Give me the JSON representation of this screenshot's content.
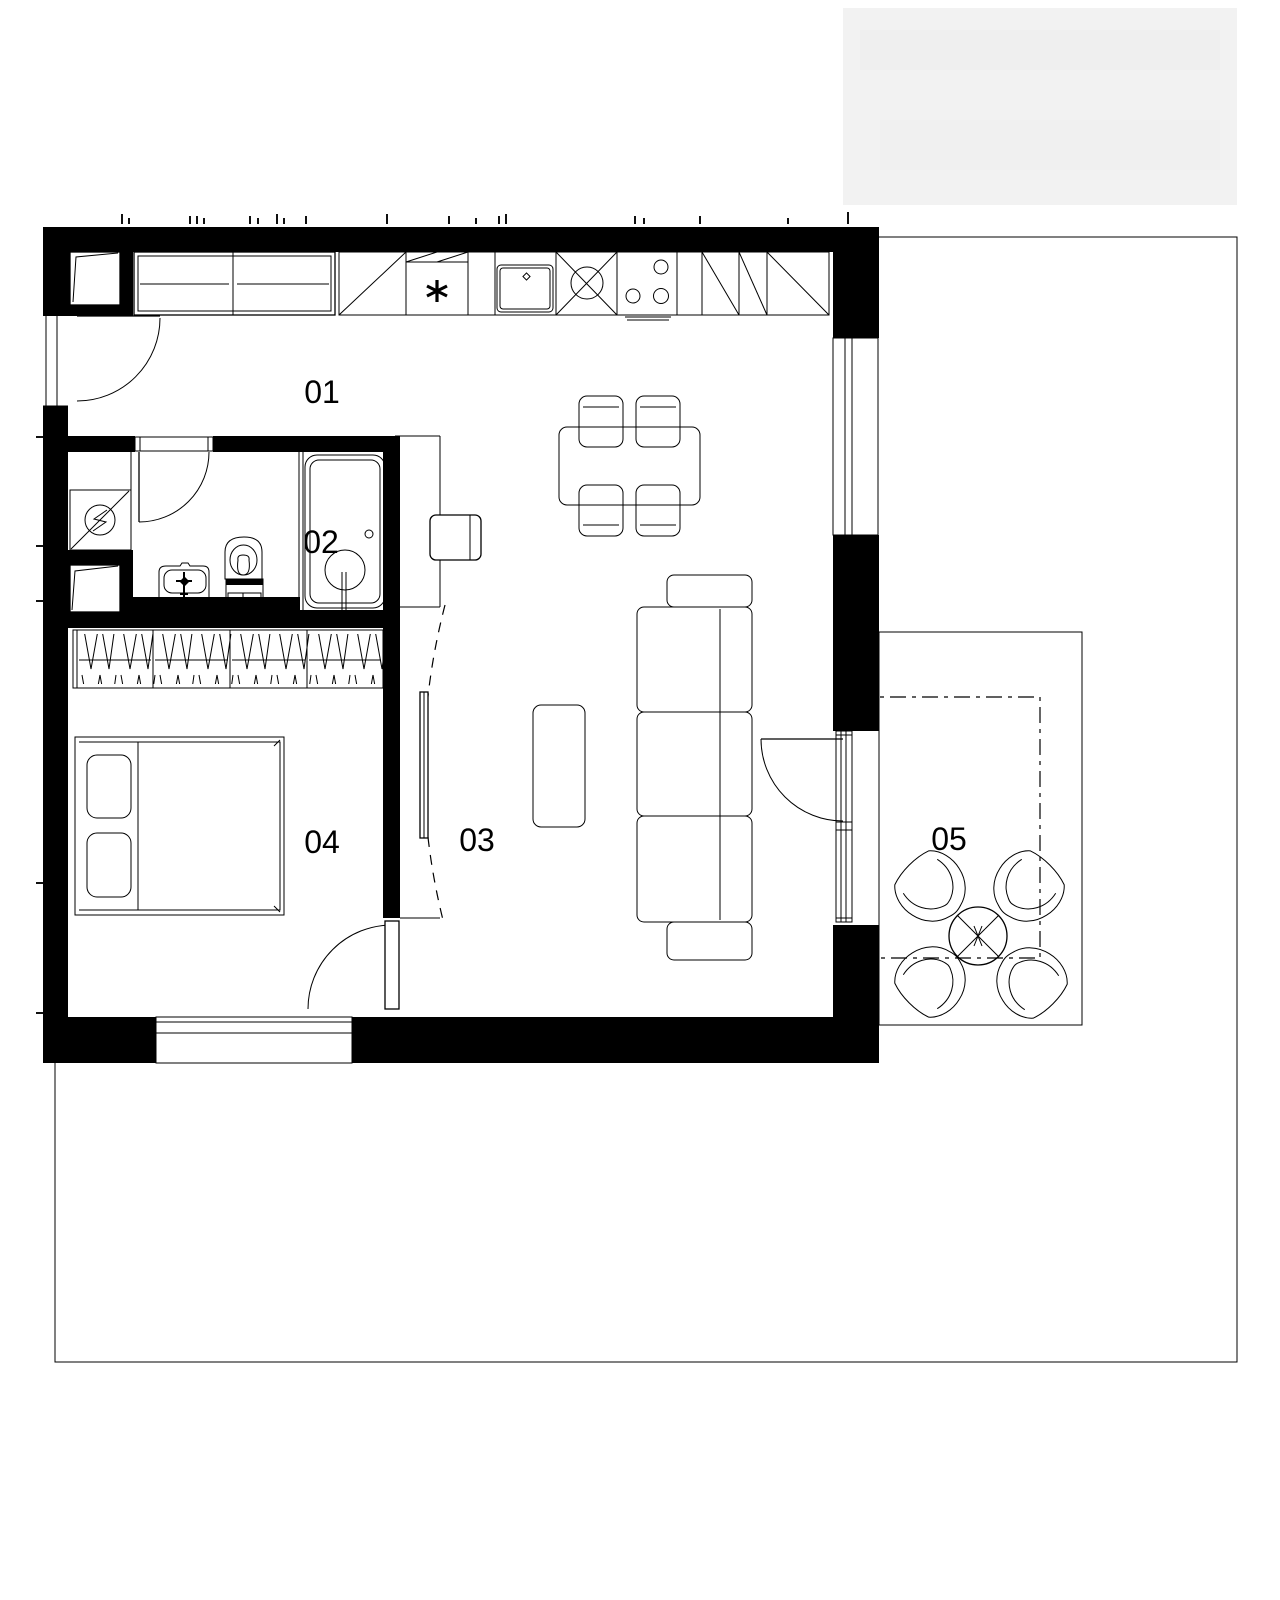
{
  "page": {
    "background": "#ffffff"
  },
  "plan": {
    "colors": {
      "wall": "#000000",
      "line": "#000000",
      "background": "#ffffff",
      "watermark": "#f2f2f2"
    },
    "rooms": [
      {
        "label": "01"
      },
      {
        "label": "02"
      },
      {
        "label": "03"
      },
      {
        "label": "04"
      },
      {
        "label": "05"
      }
    ],
    "icons": {
      "fridge": "asterisk-icon",
      "boiler": "lightning-circle-icon",
      "hob": "burner-circles-icon",
      "sink": "faucet-cross-icon",
      "balcony_table": "cross-circle-icon"
    }
  }
}
